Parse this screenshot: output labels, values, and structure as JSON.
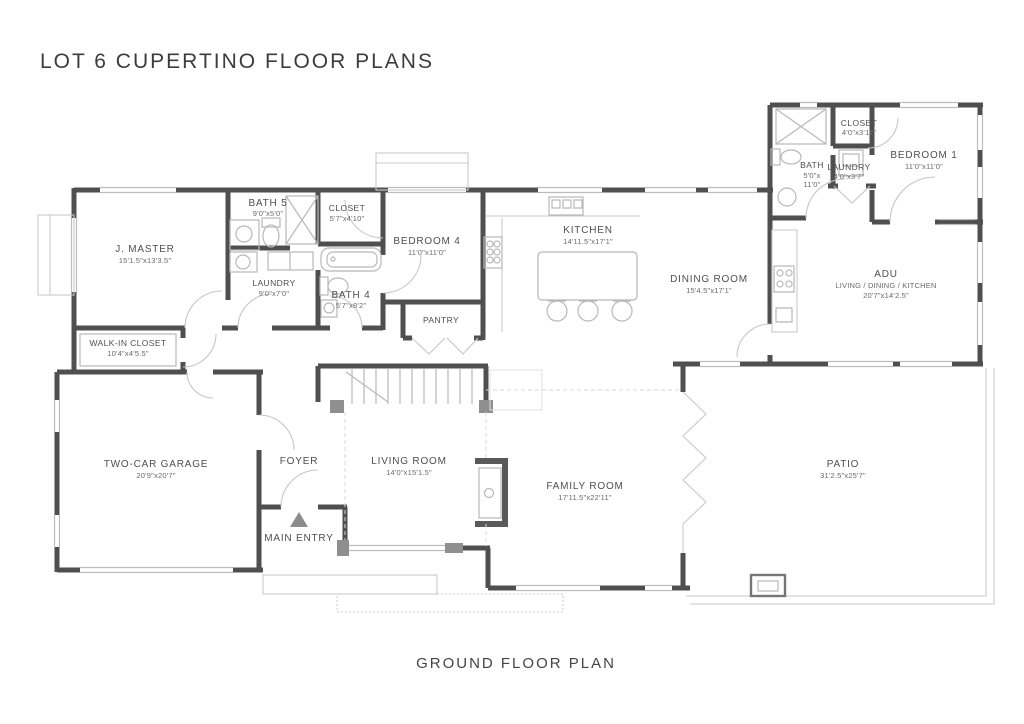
{
  "title": "LOT 6 CUPERTINO FLOOR PLANS",
  "caption": "GROUND FLOOR PLAN",
  "colors": {
    "wall": "#4f4f4f",
    "thin_line": "#b8b8b8",
    "text": "#4f4f4f",
    "entry_marker": "#8c8c8c"
  },
  "rooms": {
    "j_master": {
      "name": "J. MASTER",
      "dims": "15'1.5\"x13'3.5\""
    },
    "bath5": {
      "name": "BATH 5",
      "dims": "9'0\"x5'0\""
    },
    "closet_main": {
      "name": "CLOSET",
      "dims": "5'7\"x4'10\""
    },
    "laundry_main": {
      "name": "LAUNDRY",
      "dims": "9'0\"x7'0\""
    },
    "bath4": {
      "name": "BATH 4",
      "dims": "5'7\"x8'2\""
    },
    "bedroom4": {
      "name": "BEDROOM 4",
      "dims": "11'0\"x11'0\""
    },
    "pantry": {
      "name": "PANTRY"
    },
    "kitchen": {
      "name": "KITCHEN",
      "dims": "14'11.5\"x17'1\""
    },
    "dining": {
      "name": "DINING ROOM",
      "dims": "15'4.5\"x17'1\""
    },
    "adu": {
      "name": "ADU",
      "sub": "LIVING / DINING / KITCHEN",
      "dims": "20'7\"x14'2.5\""
    },
    "adu_bath": {
      "name": "BATH",
      "dims1": "5'0\"x",
      "dims2": "11'0\""
    },
    "adu_closet": {
      "name": "CLOSET",
      "dims": "4'0\"x3'11\""
    },
    "adu_laundry": {
      "name": "LAUNDRY",
      "dims": "4'0\"x3'7\""
    },
    "bedroom1": {
      "name": "BEDROOM 1",
      "dims": "11'0\"x11'0\""
    },
    "walk_in": {
      "name": "WALK-IN CLOSET",
      "dims": "10'4\"x4'5.5\""
    },
    "garage": {
      "name": "TWO-CAR GARAGE",
      "dims": "20'9\"x20'7\""
    },
    "foyer": {
      "name": "FOYER"
    },
    "main_entry": {
      "name": "MAIN ENTRY"
    },
    "living": {
      "name": "LIVING ROOM",
      "dims": "14'0\"x15'1.5\""
    },
    "family": {
      "name": "FAMILY ROOM",
      "dims": "17'11.5\"x22'11\""
    },
    "patio": {
      "name": "PATIO",
      "dims": "31'2.5\"x25'7\""
    }
  }
}
